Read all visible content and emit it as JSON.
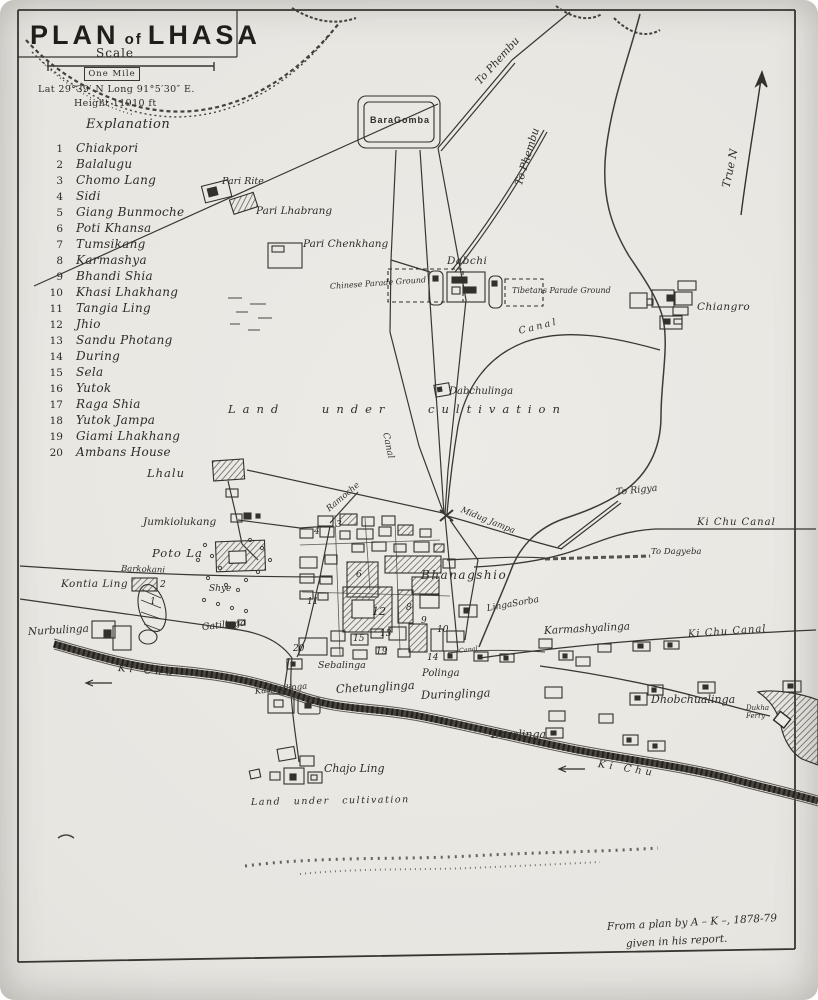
{
  "map": {
    "title_block": {
      "title_word1": "PLAN",
      "title_word2": "of",
      "title_word3": "LHASA",
      "scale_label": "Scale",
      "scale_unit": "One Mile",
      "lat_long": "Lat 29°39′ N    Long 91°5′30″ E.",
      "height": "Height 11910 ft",
      "explanation_heading": "Explanation"
    },
    "explanation": [
      {
        "num": "1",
        "name": "Chiakpori"
      },
      {
        "num": "2",
        "name": "Balalugu"
      },
      {
        "num": "3",
        "name": "Chomo Lang"
      },
      {
        "num": "4",
        "name": "Sidi"
      },
      {
        "num": "5",
        "name": "Giang Bunmoche"
      },
      {
        "num": "6",
        "name": "Poti Khansa"
      },
      {
        "num": "7",
        "name": "Tumsikang"
      },
      {
        "num": "8",
        "name": "Karmashya"
      },
      {
        "num": "9",
        "name": "Bhandi Shia"
      },
      {
        "num": "10",
        "name": "Khasi Lhakhang"
      },
      {
        "num": "11",
        "name": "Tangia Ling"
      },
      {
        "num": "12",
        "name": "Jhio"
      },
      {
        "num": "13",
        "name": "Sandu Photang"
      },
      {
        "num": "14",
        "name": "During"
      },
      {
        "num": "15",
        "name": "Sela"
      },
      {
        "num": "16",
        "name": "Yutok"
      },
      {
        "num": "17",
        "name": "Raga Shia"
      },
      {
        "num": "18",
        "name": "Yutok Jampa"
      },
      {
        "num": "19",
        "name": "Giami Lhakhang"
      },
      {
        "num": "20",
        "name": "Ambans House"
      }
    ],
    "labels": {
      "bara_gomba": "BaraGomba",
      "to_phembu_a": "To Phembu",
      "to_phembu_b": "To Phembu",
      "true_n": "True N",
      "pari_rite": "Pari Rite",
      "pari_lhabrang": "Pari Lhabrang",
      "pari_chenkhang": "Pari Chenkhang",
      "dabchi": "Dabchi",
      "chinese_parade_ground": "Chinese Parade Ground",
      "tibetans_parade_ground": "Tibetans Parade Ground",
      "chiangro": "Chiangro",
      "canal_upper": "Canal",
      "canal_vertical": "Canal",
      "canal_small": "Canal",
      "dabchulinga": "Dabchulinga",
      "land_under_cultivation_center": "Land under cultivation",
      "lhalu": "Lhalu",
      "jumkiolukang": "Jumkiolukang",
      "ramoche": "Ramoche",
      "midug_jampa": "Midug Jampa",
      "poto_la": "Poto La",
      "barkokani": "Barkokani",
      "kontia_ling": "Kontia Ling",
      "shye": "Shye",
      "nurbulinga": "Nurbulinga",
      "gatilinga": "Gatilinga",
      "bhanagshio": "Bhanagshio",
      "linga_sorba": "LingaSorba",
      "karmashyalinga": "Karmashyalinga",
      "ki_chu_canal_upper": "Ki Chu Canal",
      "ki_chu_canal_lower": "Ki Chu Canal",
      "to_rigya": "To Rigya",
      "to_dagyeba": "To Dagyeba",
      "ki_chu_west": "Ki Chu",
      "ki_chu_south": "Ki Chu",
      "sebalinga": "Sebalinga",
      "polinga": "Polinga",
      "chetunglinga": "Chetunglinga",
      "duringlinga": "Duringlinga",
      "kashyalinga": "Kashyalinga",
      "dhobchualinga": "Dhobchualinga",
      "dukha_ferry": "Dukha Ferry",
      "dorolinga": "Dorolinga",
      "chajo_ling": "Chajo Ling",
      "land_under_cultivation_south": "Land under cultivation"
    },
    "marker_values": [
      "1",
      "2",
      "3",
      "4",
      "6",
      "8",
      "9",
      "10",
      "11",
      "12",
      "13",
      "14",
      "15",
      "19",
      "20"
    ],
    "attribution": {
      "line1": "From a plan by A – K –, 1878-79",
      "line2": "given in his report."
    },
    "colors": {
      "ink": "#3a3733",
      "paper": "#eceae5"
    }
  }
}
